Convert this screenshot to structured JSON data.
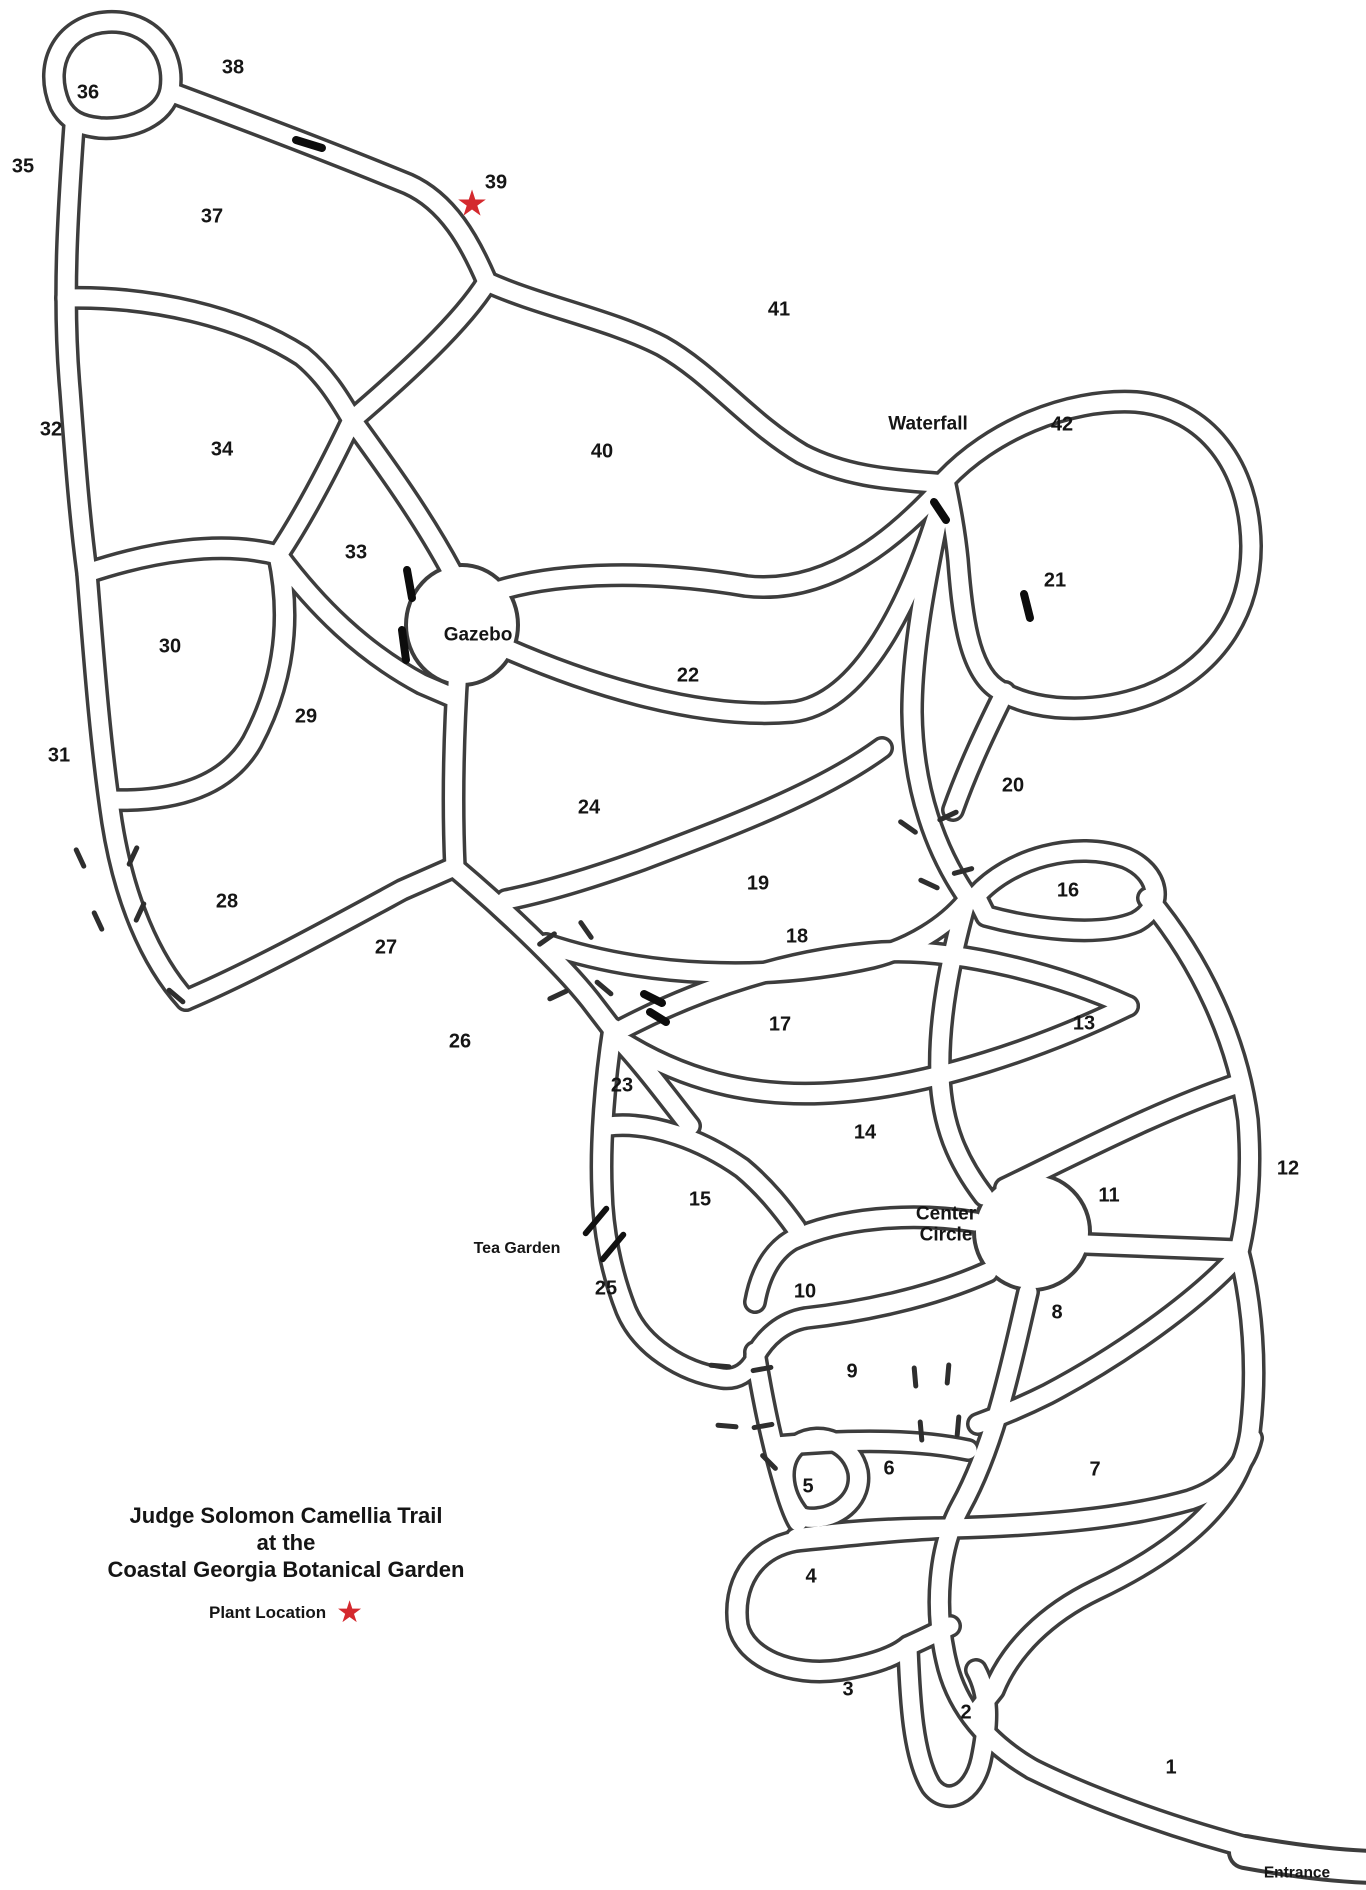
{
  "title": {
    "line1": "Judge Solomon Camellia Trail",
    "line2": "at the",
    "line3": "Coastal Georgia Botanical Garden"
  },
  "legend": {
    "label": "Plant Location",
    "star_icon": "red-star"
  },
  "colors": {
    "trail_line": "#3d3d3d",
    "text": "#151515",
    "star": "#d4292e",
    "background": "#ffffff"
  },
  "map": {
    "beds": [
      {
        "n": "1",
        "x": 1171,
        "y": 1768
      },
      {
        "n": "2",
        "x": 966,
        "y": 1713
      },
      {
        "n": "3",
        "x": 848,
        "y": 1690
      },
      {
        "n": "4",
        "x": 811,
        "y": 1577
      },
      {
        "n": "5",
        "x": 808,
        "y": 1487
      },
      {
        "n": "6",
        "x": 889,
        "y": 1469
      },
      {
        "n": "7",
        "x": 1095,
        "y": 1470
      },
      {
        "n": "8",
        "x": 1057,
        "y": 1313
      },
      {
        "n": "9",
        "x": 852,
        "y": 1372
      },
      {
        "n": "10",
        "x": 805,
        "y": 1292
      },
      {
        "n": "11",
        "x": 1109,
        "y": 1196
      },
      {
        "n": "12",
        "x": 1288,
        "y": 1169
      },
      {
        "n": "13",
        "x": 1084,
        "y": 1024
      },
      {
        "n": "14",
        "x": 865,
        "y": 1133
      },
      {
        "n": "15",
        "x": 700,
        "y": 1200
      },
      {
        "n": "16",
        "x": 1068,
        "y": 891
      },
      {
        "n": "17",
        "x": 780,
        "y": 1025
      },
      {
        "n": "18",
        "x": 797,
        "y": 937
      },
      {
        "n": "19",
        "x": 758,
        "y": 884
      },
      {
        "n": "20",
        "x": 1013,
        "y": 786
      },
      {
        "n": "21",
        "x": 1055,
        "y": 581
      },
      {
        "n": "22",
        "x": 688,
        "y": 676
      },
      {
        "n": "23",
        "x": 622,
        "y": 1086
      },
      {
        "n": "24",
        "x": 589,
        "y": 808
      },
      {
        "n": "25",
        "x": 606,
        "y": 1289
      },
      {
        "n": "26",
        "x": 460,
        "y": 1042
      },
      {
        "n": "27",
        "x": 386,
        "y": 948
      },
      {
        "n": "28",
        "x": 227,
        "y": 902
      },
      {
        "n": "29",
        "x": 306,
        "y": 717
      },
      {
        "n": "30",
        "x": 170,
        "y": 647
      },
      {
        "n": "31",
        "x": 59,
        "y": 756
      },
      {
        "n": "32",
        "x": 51,
        "y": 430
      },
      {
        "n": "33",
        "x": 356,
        "y": 553
      },
      {
        "n": "34",
        "x": 222,
        "y": 450
      },
      {
        "n": "35",
        "x": 23,
        "y": 167
      },
      {
        "n": "36",
        "x": 88,
        "y": 93
      },
      {
        "n": "37",
        "x": 212,
        "y": 217
      },
      {
        "n": "38",
        "x": 233,
        "y": 68
      },
      {
        "n": "39",
        "x": 496,
        "y": 183
      },
      {
        "n": "40",
        "x": 602,
        "y": 452
      },
      {
        "n": "41",
        "x": 779,
        "y": 310
      },
      {
        "n": "42",
        "x": 1062,
        "y": 425
      }
    ],
    "landmarks": [
      {
        "id": "gazebo",
        "text": "Gazebo",
        "x": 478,
        "y": 635,
        "cls": ""
      },
      {
        "id": "waterfall",
        "text": "Waterfall",
        "x": 928,
        "y": 424,
        "cls": ""
      },
      {
        "id": "center-circle",
        "text": "Center\nCircle",
        "x": 946,
        "y": 1225,
        "cls": ""
      },
      {
        "id": "tea-garden",
        "text": "Tea Garden",
        "x": 517,
        "y": 1249,
        "cls": "landmark-small"
      },
      {
        "id": "entrance",
        "text": "Entrance",
        "x": 1297,
        "y": 1873,
        "cls": "landmark-entrance"
      }
    ],
    "plant_stars": [
      {
        "id": "plant-location-39",
        "x": 472,
        "y": 205,
        "size": 36
      }
    ]
  }
}
